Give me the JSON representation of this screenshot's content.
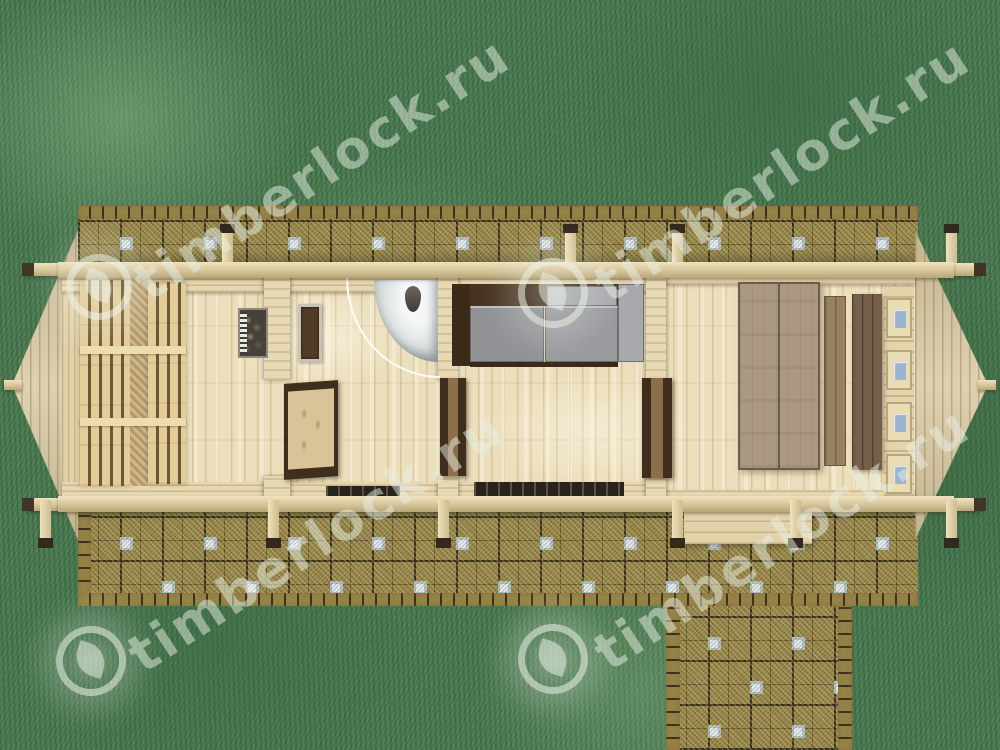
{
  "watermark": {
    "text": "timberlock.ru",
    "instance_count": 4,
    "logo": "leaf-in-circle-icon",
    "color": "#e8f0e4"
  },
  "palette": {
    "grass": "#4c7b52",
    "grass_dark": "#2f5d3a",
    "grass_light": "#8fb38a",
    "paving_olive": "#97894e",
    "paving_grout": "#39301d",
    "paving_blue_tile": "#b2c4da",
    "pine_light": "#ecdfbc",
    "pine_mid": "#d9cba6",
    "frame_dark_brown": "#3f2e1d",
    "sofa_cushion_grey": "#909296",
    "shower_white": "#f1f3f3",
    "table_weathered": "#ab9880",
    "mat_dark": "#27231d"
  }
}
